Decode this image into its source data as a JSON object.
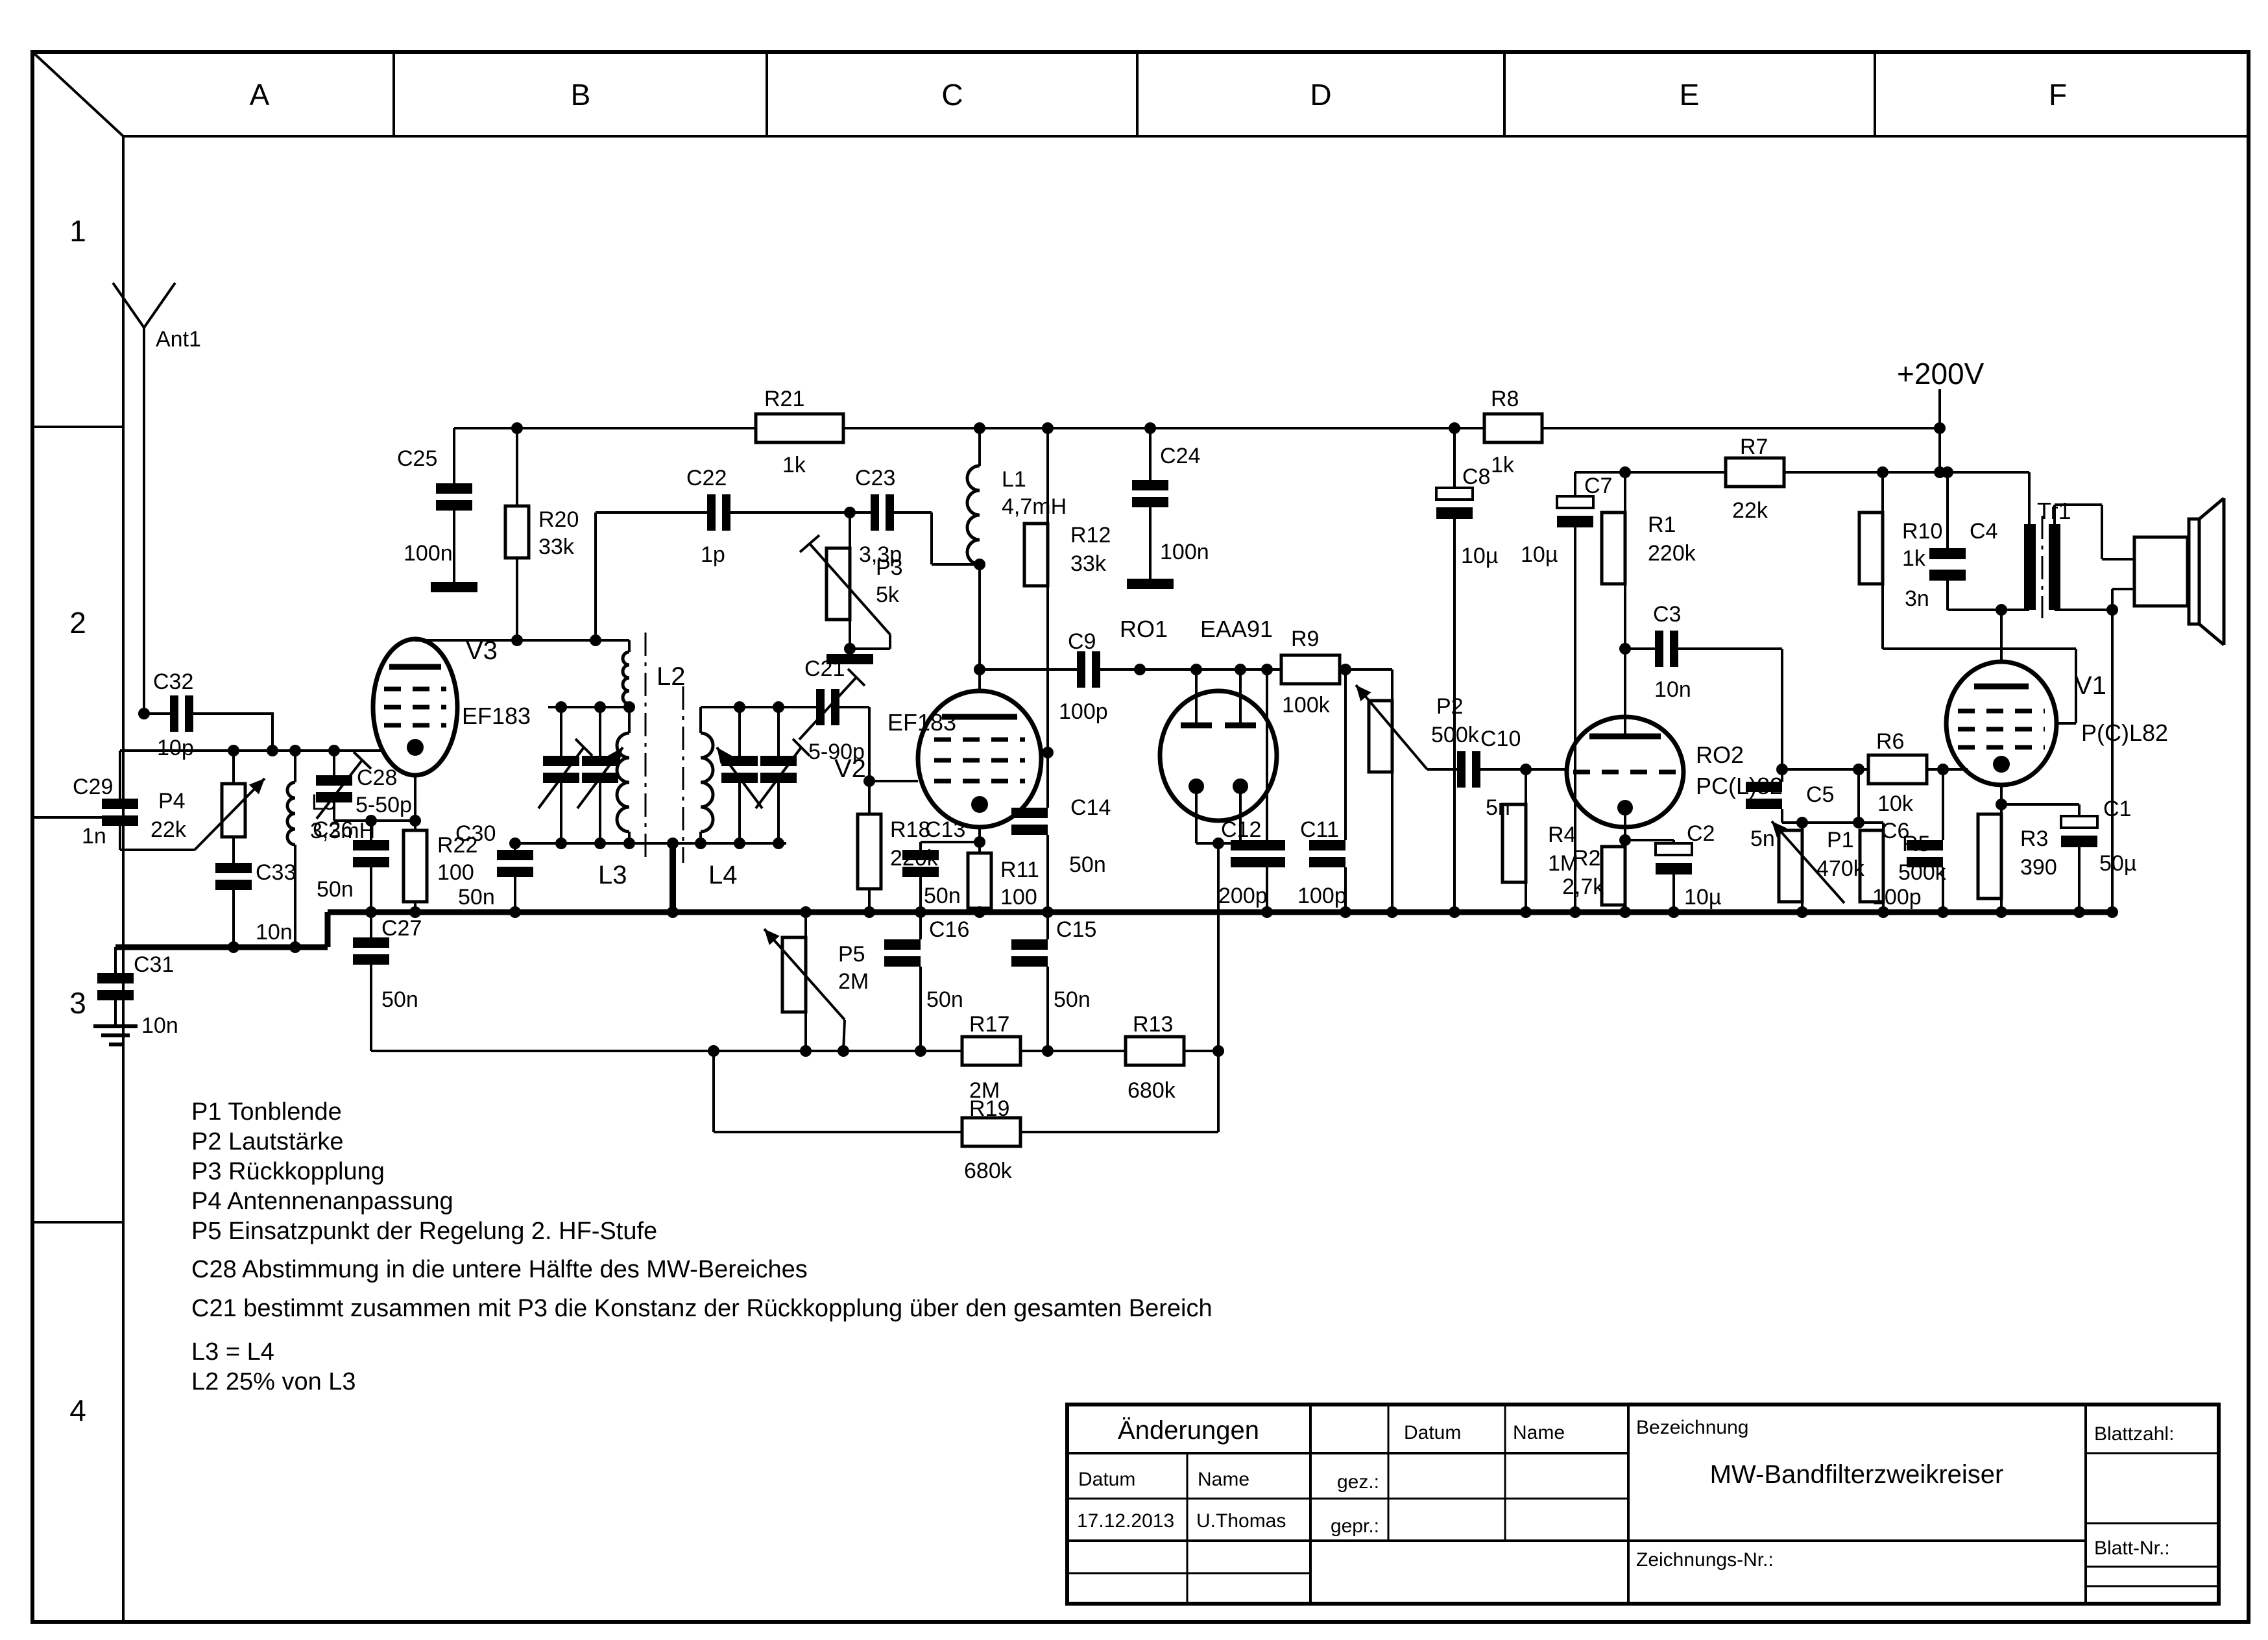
{
  "frame": {
    "columns": [
      "A",
      "B",
      "C",
      "D",
      "E",
      "F"
    ],
    "rows": [
      "1",
      "2",
      "3",
      "4"
    ]
  },
  "power_label": "+200V",
  "notes": [
    "P1 Tonblende",
    "P2 Lautstärke",
    "P3 Rückkopplung",
    "P4 Antennenanpassung",
    "P5 Einsatzpunkt der Regelung 2. HF-Stufe",
    "C28 Abstimmung in die untere Hälfte des MW-Bereiches",
    "C21 bestimmt zusammen mit P3 die Konstanz der Rückkopplung über den gesamten Bereich",
    "L3 = L4",
    "L2 25% von L3"
  ],
  "title_block": {
    "aenderungen": "Änderungen",
    "datum_label": "Datum",
    "name_label": "Name",
    "datum2_label": "Datum",
    "name2_label": "Name",
    "gez_label": "gez.:",
    "gepr_label": "gepr.:",
    "bezeichnung_label": "Bezeichnung",
    "title": "MW-Bandfilterzweikreiser",
    "zeichnungs_nr_label": "Zeichnungs-Nr.:",
    "blattzahl_label": "Blattzahl:",
    "blatt_nr_label": "Blatt-Nr.:",
    "date_value": "17.12.2013",
    "name_value": "U.Thomas"
  },
  "components": {
    "ant1": {
      "ref": "Ant1"
    },
    "c32": {
      "ref": "C32",
      "val": "10p"
    },
    "c29": {
      "ref": "C29",
      "val": "1n"
    },
    "p4": {
      "ref": "P4",
      "val": "22k"
    },
    "l5": {
      "ref": "L5",
      "val": "3,3mH"
    },
    "c33": {
      "ref": "C33",
      "val": "10n"
    },
    "c31": {
      "ref": "C31",
      "val": "10n"
    },
    "c28": {
      "ref": "C28",
      "val": "5-50p"
    },
    "c26": {
      "ref": "C26",
      "val": "50n"
    },
    "r22": {
      "ref": "R22",
      "val": "100"
    },
    "c27": {
      "ref": "C27",
      "val": "50n"
    },
    "v3": {
      "ref": "V3",
      "val": "EF183"
    },
    "c25": {
      "ref": "C25",
      "val": "100n"
    },
    "r20": {
      "ref": "R20",
      "val": "33k"
    },
    "r21": {
      "ref": "R21",
      "val": "1k"
    },
    "l2": {
      "ref": "L2"
    },
    "l3": {
      "ref": "L3"
    },
    "l4": {
      "ref": "L4"
    },
    "c30": {
      "ref": "C30",
      "val": "50n"
    },
    "c22": {
      "ref": "C22",
      "val": "1p"
    },
    "c23": {
      "ref": "C23",
      "val": "3,3p"
    },
    "p3": {
      "ref": "P3",
      "val": "5k"
    },
    "c21": {
      "ref": "C21",
      "val": "5-90p"
    },
    "l1": {
      "ref": "L1",
      "val": "4,7mH"
    },
    "r12": {
      "ref": "R12",
      "val": "33k"
    },
    "v2": {
      "ref": "V2",
      "val": "EF183"
    },
    "r18": {
      "ref": "R18",
      "val": "220k"
    },
    "c13": {
      "ref": "C13",
      "val": "50n"
    },
    "r11": {
      "ref": "R11",
      "val": "100"
    },
    "c14": {
      "ref": "C14",
      "val": "50n"
    },
    "c16": {
      "ref": "C16",
      "val": "50n"
    },
    "c15": {
      "ref": "C15",
      "val": "50n"
    },
    "p5": {
      "ref": "P5",
      "val": "2M"
    },
    "r17": {
      "ref": "R17",
      "val": "2M"
    },
    "r19": {
      "ref": "R19",
      "val": "680k"
    },
    "r13": {
      "ref": "R13",
      "val": "680k"
    },
    "c9": {
      "ref": "C9",
      "val": "100p"
    },
    "ro1": {
      "ref": "RO1",
      "val": "EAA91"
    },
    "r9": {
      "ref": "R9",
      "val": "100k"
    },
    "c12": {
      "ref": "C12",
      "val": "200p"
    },
    "c11": {
      "ref": "C11",
      "val": "100p"
    },
    "p2": {
      "ref": "P2",
      "val": "500k"
    },
    "c10": {
      "ref": "C10",
      "val": "5n"
    },
    "r4": {
      "ref": "R4",
      "val": "1M"
    },
    "c24": {
      "ref": "C24",
      "val": "100n"
    },
    "c8": {
      "ref": "C8",
      "val": "10µ"
    },
    "r8": {
      "ref": "R8",
      "val": "1k"
    },
    "c7": {
      "ref": "C7",
      "val": "10µ"
    },
    "r7": {
      "ref": "R7",
      "val": "22k"
    },
    "r1": {
      "ref": "R1",
      "val": "220k"
    },
    "c3": {
      "ref": "C3",
      "val": "10n"
    },
    "ro2": {
      "ref": "RO2",
      "val": "PC(L)82"
    },
    "r2": {
      "ref": "R2",
      "val": "2,7k"
    },
    "c2": {
      "ref": "C2",
      "val": "10µ"
    },
    "c5": {
      "ref": "C5",
      "val": "5n"
    },
    "p1": {
      "ref": "P1",
      "val": "470k"
    },
    "r5": {
      "ref": "R5",
      "val": "500k"
    },
    "r6": {
      "ref": "R6",
      "val": "10k"
    },
    "c6": {
      "ref": "C6",
      "val": "100p"
    },
    "r10": {
      "ref": "R10",
      "val": "1k"
    },
    "c4": {
      "ref": "C4",
      "val": "3n"
    },
    "tr1": {
      "ref": "Tr1"
    },
    "v1": {
      "ref": "V1",
      "val": "P(C)L82"
    },
    "r3": {
      "ref": "R3",
      "val": "390"
    },
    "c1": {
      "ref": "C1",
      "val": "50µ"
    }
  }
}
